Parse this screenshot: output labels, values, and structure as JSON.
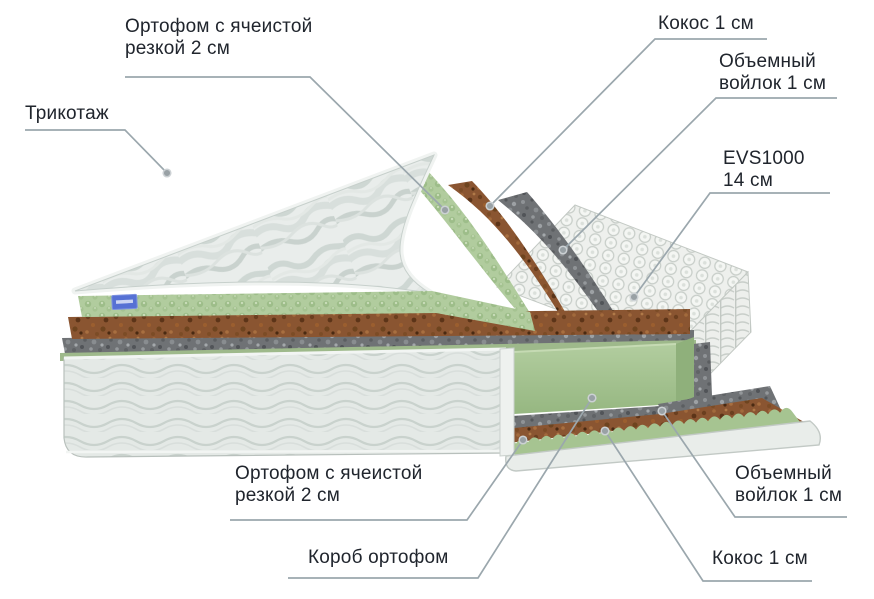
{
  "diagram": {
    "labels": {
      "ortofoam_top": "Ортофом с ячеистой\nрезкой 2 см",
      "trikotazh": "Трикотаж",
      "kokos_top": "Кокос 1 см",
      "voilok_top": "Объемный\nвойлок 1 см",
      "evs": "EVS1000\n14 см",
      "ortofoam_bottom": "Ортофом с ячеистой\nрезкой 2 см",
      "korob": "Короб ортофом",
      "voilok_bottom": "Объемный\nвойлок 1 см",
      "kokos_bottom": "Кокос 1 см"
    },
    "colors": {
      "text": "#20252d",
      "leader_line": "#9ba7ad",
      "foam_green": "#aecb9b",
      "foam_green_dark": "#8fb07b",
      "coir_brown": "#8a5531",
      "felt_gray": "#6f7275",
      "fabric_white": "#e9edeb",
      "springs_white": "#f2f3f1",
      "tag_blue": "#5671d4"
    }
  }
}
